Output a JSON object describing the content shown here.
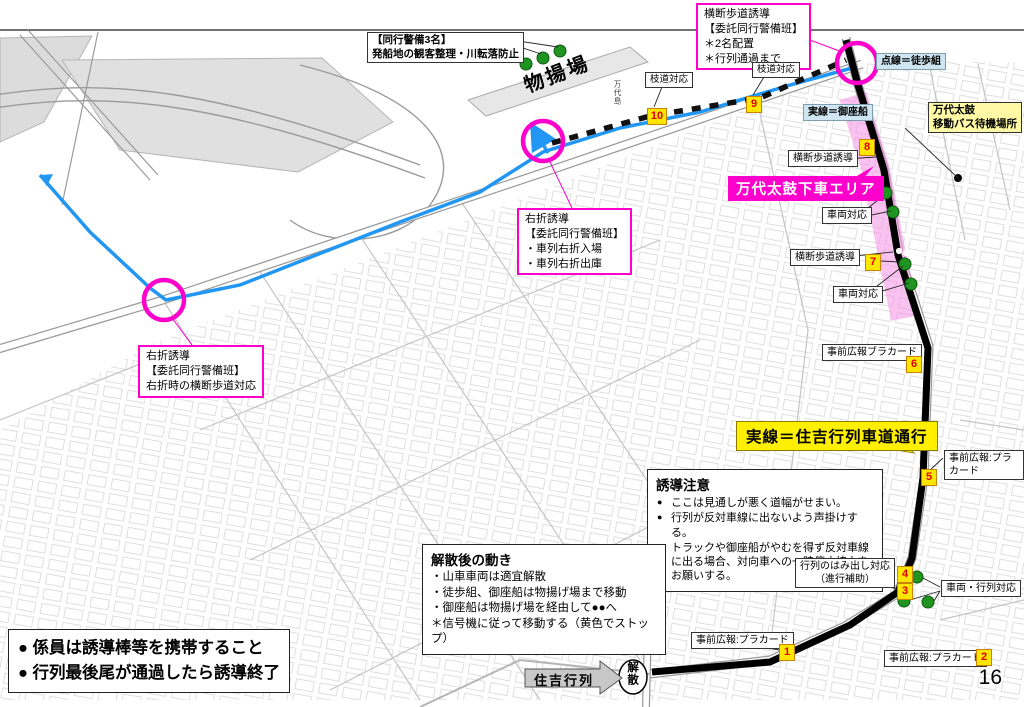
{
  "header": {
    "title": "■人員・備品配置図　1日目；土曜日　3班（沼垂東・R113）、4班（物揚場）",
    "right": "令和6年 住吉行列等"
  },
  "page_number": "16",
  "legend": {
    "dotted_walk": "点線＝徒歩組",
    "solid_boat": "実線＝御座船",
    "solid_parade": "実線＝住吉行列車道通行"
  },
  "areas": {
    "monoageba": "物揚場",
    "bandai_area": "万代太鼓下車エリア",
    "bandai_bus": "万代太鼓\n移動バス待機場所",
    "kaisan": "解散",
    "sumiyoshi_arrow": "住吉行列",
    "street_kurinoki": "栗ノ木バイパス",
    "street_bandaijima": "万代島"
  },
  "callouts": {
    "crosswalk_top": "横断歩道誘導\n【委託同行警備班】\n＊2名配置\n＊行列通過まで",
    "escort3": "【同行警備3名】\n発船地の観客整理・川転落防止",
    "edamichi_10": "枝道対応",
    "edamichi_9": "枝道対応",
    "crosswalk_guide_1": "横断歩道誘導",
    "vehicle_1": "車両対応",
    "crosswalk_guide_2": "横断歩道誘導",
    "vehicle_2": "車両対応",
    "placard_6": "事前広報ブラカード",
    "placard_5": "事前広報:プラカード",
    "right_turn_mid": "右折誘導\n【委託同行警備班】\n・車列右折入場\n・車列右折出庫",
    "right_turn_left": "右折誘導\n【委託同行警備班】\n右折時の横断歩道対応",
    "hamidashi": "行列のはみ出し対応\n（進行補助）",
    "vehicle_parade": "車両・行列対応",
    "placard_2": "事前広報:プラカード",
    "placard_1": "事前広報:プラカード"
  },
  "caution": {
    "title": "誘導注意",
    "items": [
      "ここは見通しが悪く道幅がせまい。",
      "行列が反対車線に出ないよう声掛けする。",
      "トラックや御座船がやむを得ず反対車線に出る場合、対向車への一時停止協力をお願いする。"
    ]
  },
  "after_dispersal": {
    "title": "解散後の動き",
    "lines": "・山車車両は適宜解散\n・徒歩組、御座船は物揚げ場まで移動\n・御座船は物揚げ場を経由して●●へ\n＊信号機に従って移動する（黄色でストップ）"
  },
  "notes": {
    "lines": "● 係員は誘導棒等を携帯すること\n● 行列最後尾が通過したら誘導終了"
  },
  "badges": {
    "b1": "1",
    "b2": "2",
    "b3": "3",
    "b4": "4",
    "b5": "5",
    "b6": "6",
    "b7": "7",
    "b8": "8",
    "b9": "9",
    "b10": "10"
  },
  "colors": {
    "accent_magenta": "#ff00cc",
    "route_black": "#000000",
    "route_blue": "#2196f3",
    "corridor_pink": "#f48fe4",
    "badge_yellow": "#ffe600",
    "badge_number_red": "#e00000",
    "staff_dot_green": "#1f9420",
    "legend_blue_bg": "#cfe6f2",
    "highlight_yellow": "#ffef00"
  }
}
